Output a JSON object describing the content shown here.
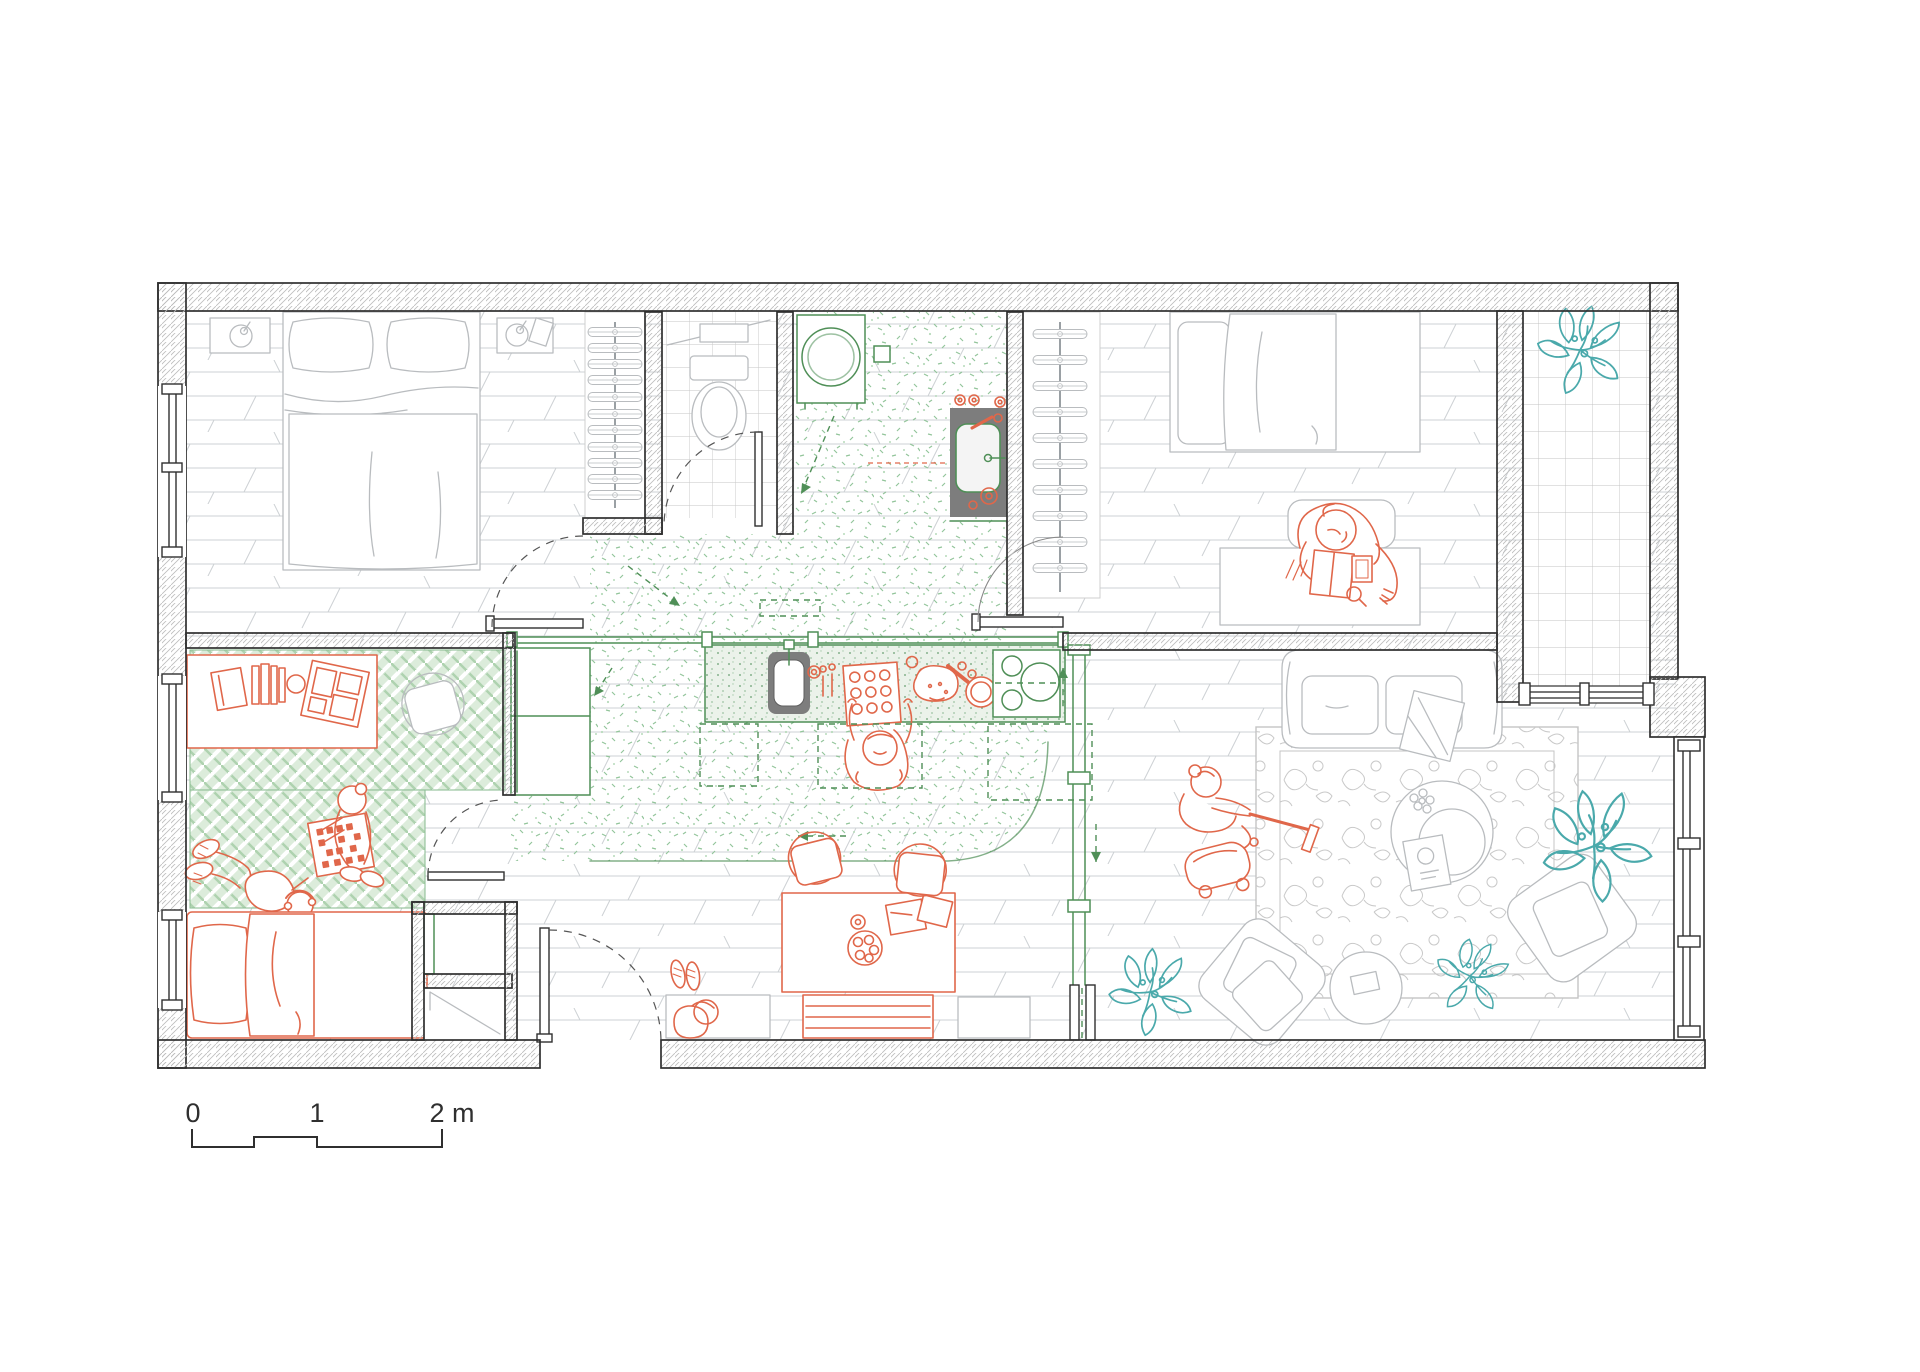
{
  "scale_bar": {
    "label_0": "0",
    "label_1": "1",
    "label_2": "2 m"
  },
  "colors": {
    "accent_orange": "#e0674a",
    "fixture_green": "#4f8f57",
    "speckle_green": "#93c59b",
    "mat_green": "#aed2af",
    "plant_teal": "#4aa9ab",
    "wall_ink": "#2f2f2f",
    "floor_line": "#cdd1d4",
    "furniture_gray": "#b9bcbf",
    "rug_gray": "#c9c9c9",
    "sink_dark": "#7d7d7d"
  },
  "elements": {
    "rooms": [
      "master-bedroom",
      "walk-in-closet",
      "bathroom",
      "laundry",
      "second-bedroom",
      "kids-room",
      "kitchen",
      "dining-area",
      "living-room",
      "entry",
      "balcony"
    ],
    "symbols": [
      "double-bed",
      "single-bed",
      "kids-bed",
      "nightstand-lamp",
      "clothes-hangers",
      "toilet",
      "washing-machine",
      "laundry-sink",
      "kitchen-sink",
      "cooktop",
      "baking-tray",
      "dining-table",
      "dining-chairs",
      "storage-bench",
      "shoe-bench",
      "sofa",
      "area-rug",
      "coffee-table",
      "armchair",
      "pouf",
      "desk",
      "play-mat",
      "game-board",
      "vacuum-cleaner",
      "potted-plants",
      "door-swings",
      "scale-bar"
    ],
    "people": [
      "person-baking",
      "person-at-desk",
      "person-vacuuming",
      "two-children-playing"
    ]
  }
}
